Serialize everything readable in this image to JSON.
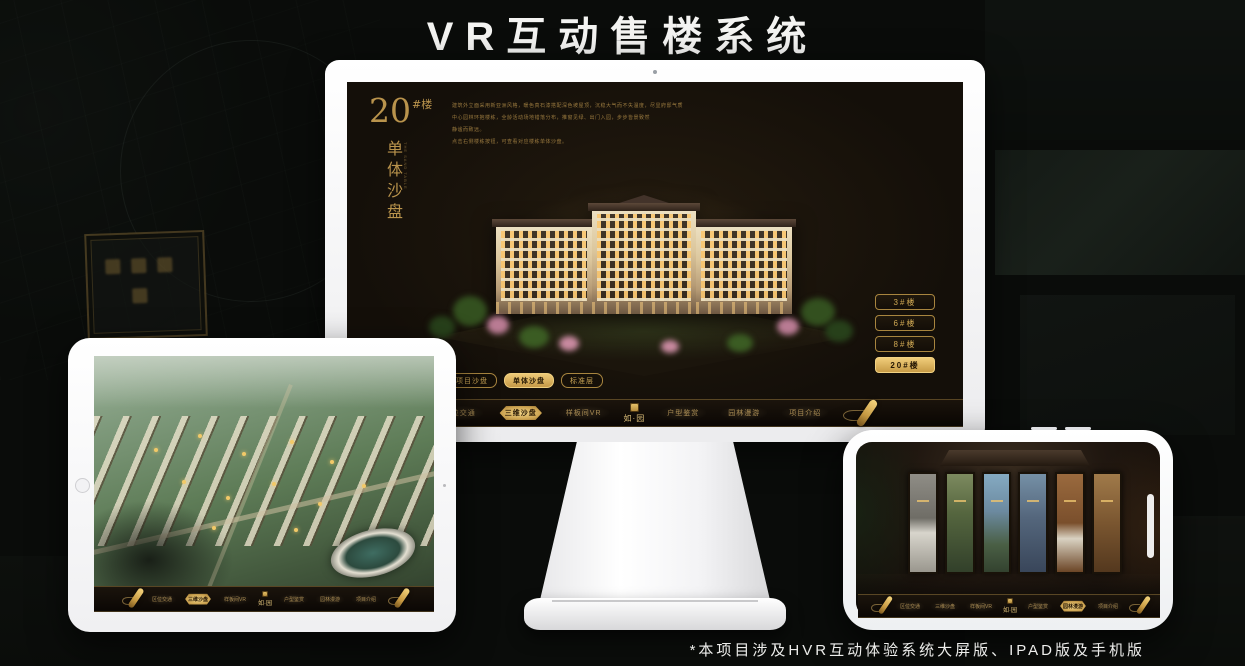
{
  "title": "VR互动售楼系统",
  "footnote": "*本项目涉及HVR互动体验系统大屏版、IPAD版及手机版",
  "brand": {
    "name": "如·园"
  },
  "menu": {
    "items": [
      "区位交通",
      "三维沙盘",
      "样板间VR",
      "户型鉴赏",
      "园林漫游",
      "项目介绍"
    ],
    "monitor_active": "三维沙盘",
    "ipad_active": "三维沙盘",
    "phone_active": "园林漫游"
  },
  "monitor": {
    "block_no": "20",
    "block_unit": "#楼",
    "block_title": "单体沙盘",
    "block_title_en": "THE SAND TABLE",
    "desc_lines": [
      "建筑外立面采用新亚洲风格，暖色真石漆搭配深色坡屋顶，沉稳大气而不失温度，尽显府邸气质",
      "中心园林环抱楼栋，全龄活动场地错落分布，推窗见绿、出门入园，步步皆景致然",
      "静谧而致远。",
      "点击右侧楼栋按钮，可查看对应楼栋单体沙盘。"
    ],
    "floor_buttons": [
      {
        "label": "3#楼",
        "active": false
      },
      {
        "label": "6#楼",
        "active": false
      },
      {
        "label": "8#楼",
        "active": false
      },
      {
        "label": "20#楼",
        "active": true
      }
    ],
    "tabs": [
      {
        "label": "项目沙盘",
        "active": false
      },
      {
        "label": "单体沙盘",
        "active": true
      },
      {
        "label": "标准层",
        "active": false
      }
    ]
  },
  "colors": {
    "gold": "#c9a254",
    "gold_bright": "#eed084",
    "screen_bg": "#140f09",
    "background": "#0a0c0a",
    "title_white": "#f4f4f2"
  }
}
